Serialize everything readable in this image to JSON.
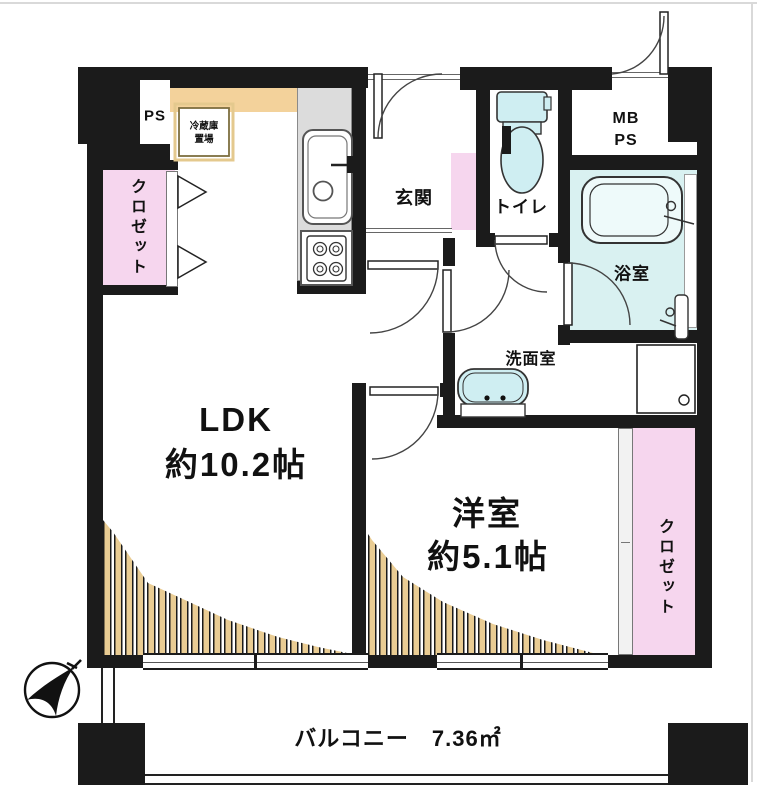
{
  "plan_title": "1LDK apartment floor plan",
  "rooms": {
    "ldk": {
      "name": "LDK",
      "size": "約10.2帖"
    },
    "western_room": {
      "name": "洋室",
      "size": "約5.1帖"
    },
    "balcony": {
      "label": "バルコニー　7.36㎡"
    },
    "entrance": {
      "label": "玄関"
    },
    "toilet": {
      "label": "トイレ"
    },
    "bathroom": {
      "label": "浴室"
    },
    "washroom": {
      "label": "洗面室"
    },
    "closet_left": {
      "label": "クロゼット"
    },
    "closet_right": {
      "label": "クロゼット"
    },
    "pipe_space": {
      "label": "PS"
    },
    "meter_box": {
      "line1": "MB",
      "line2": "PS"
    },
    "fridge_space": {
      "line1": "冷蔵庫",
      "line2": "置場"
    }
  },
  "compass": {
    "icon": "north-arrow",
    "points": "north-east"
  },
  "colors": {
    "wall": "#1b1b1b",
    "closet_pink": "#f6d6ee",
    "water_cyan": "#d9f1f1",
    "counter_tan": "#f3d29b",
    "hatch_tan": "#e9cc93",
    "kitchen_gray": "#dcdcdc"
  }
}
